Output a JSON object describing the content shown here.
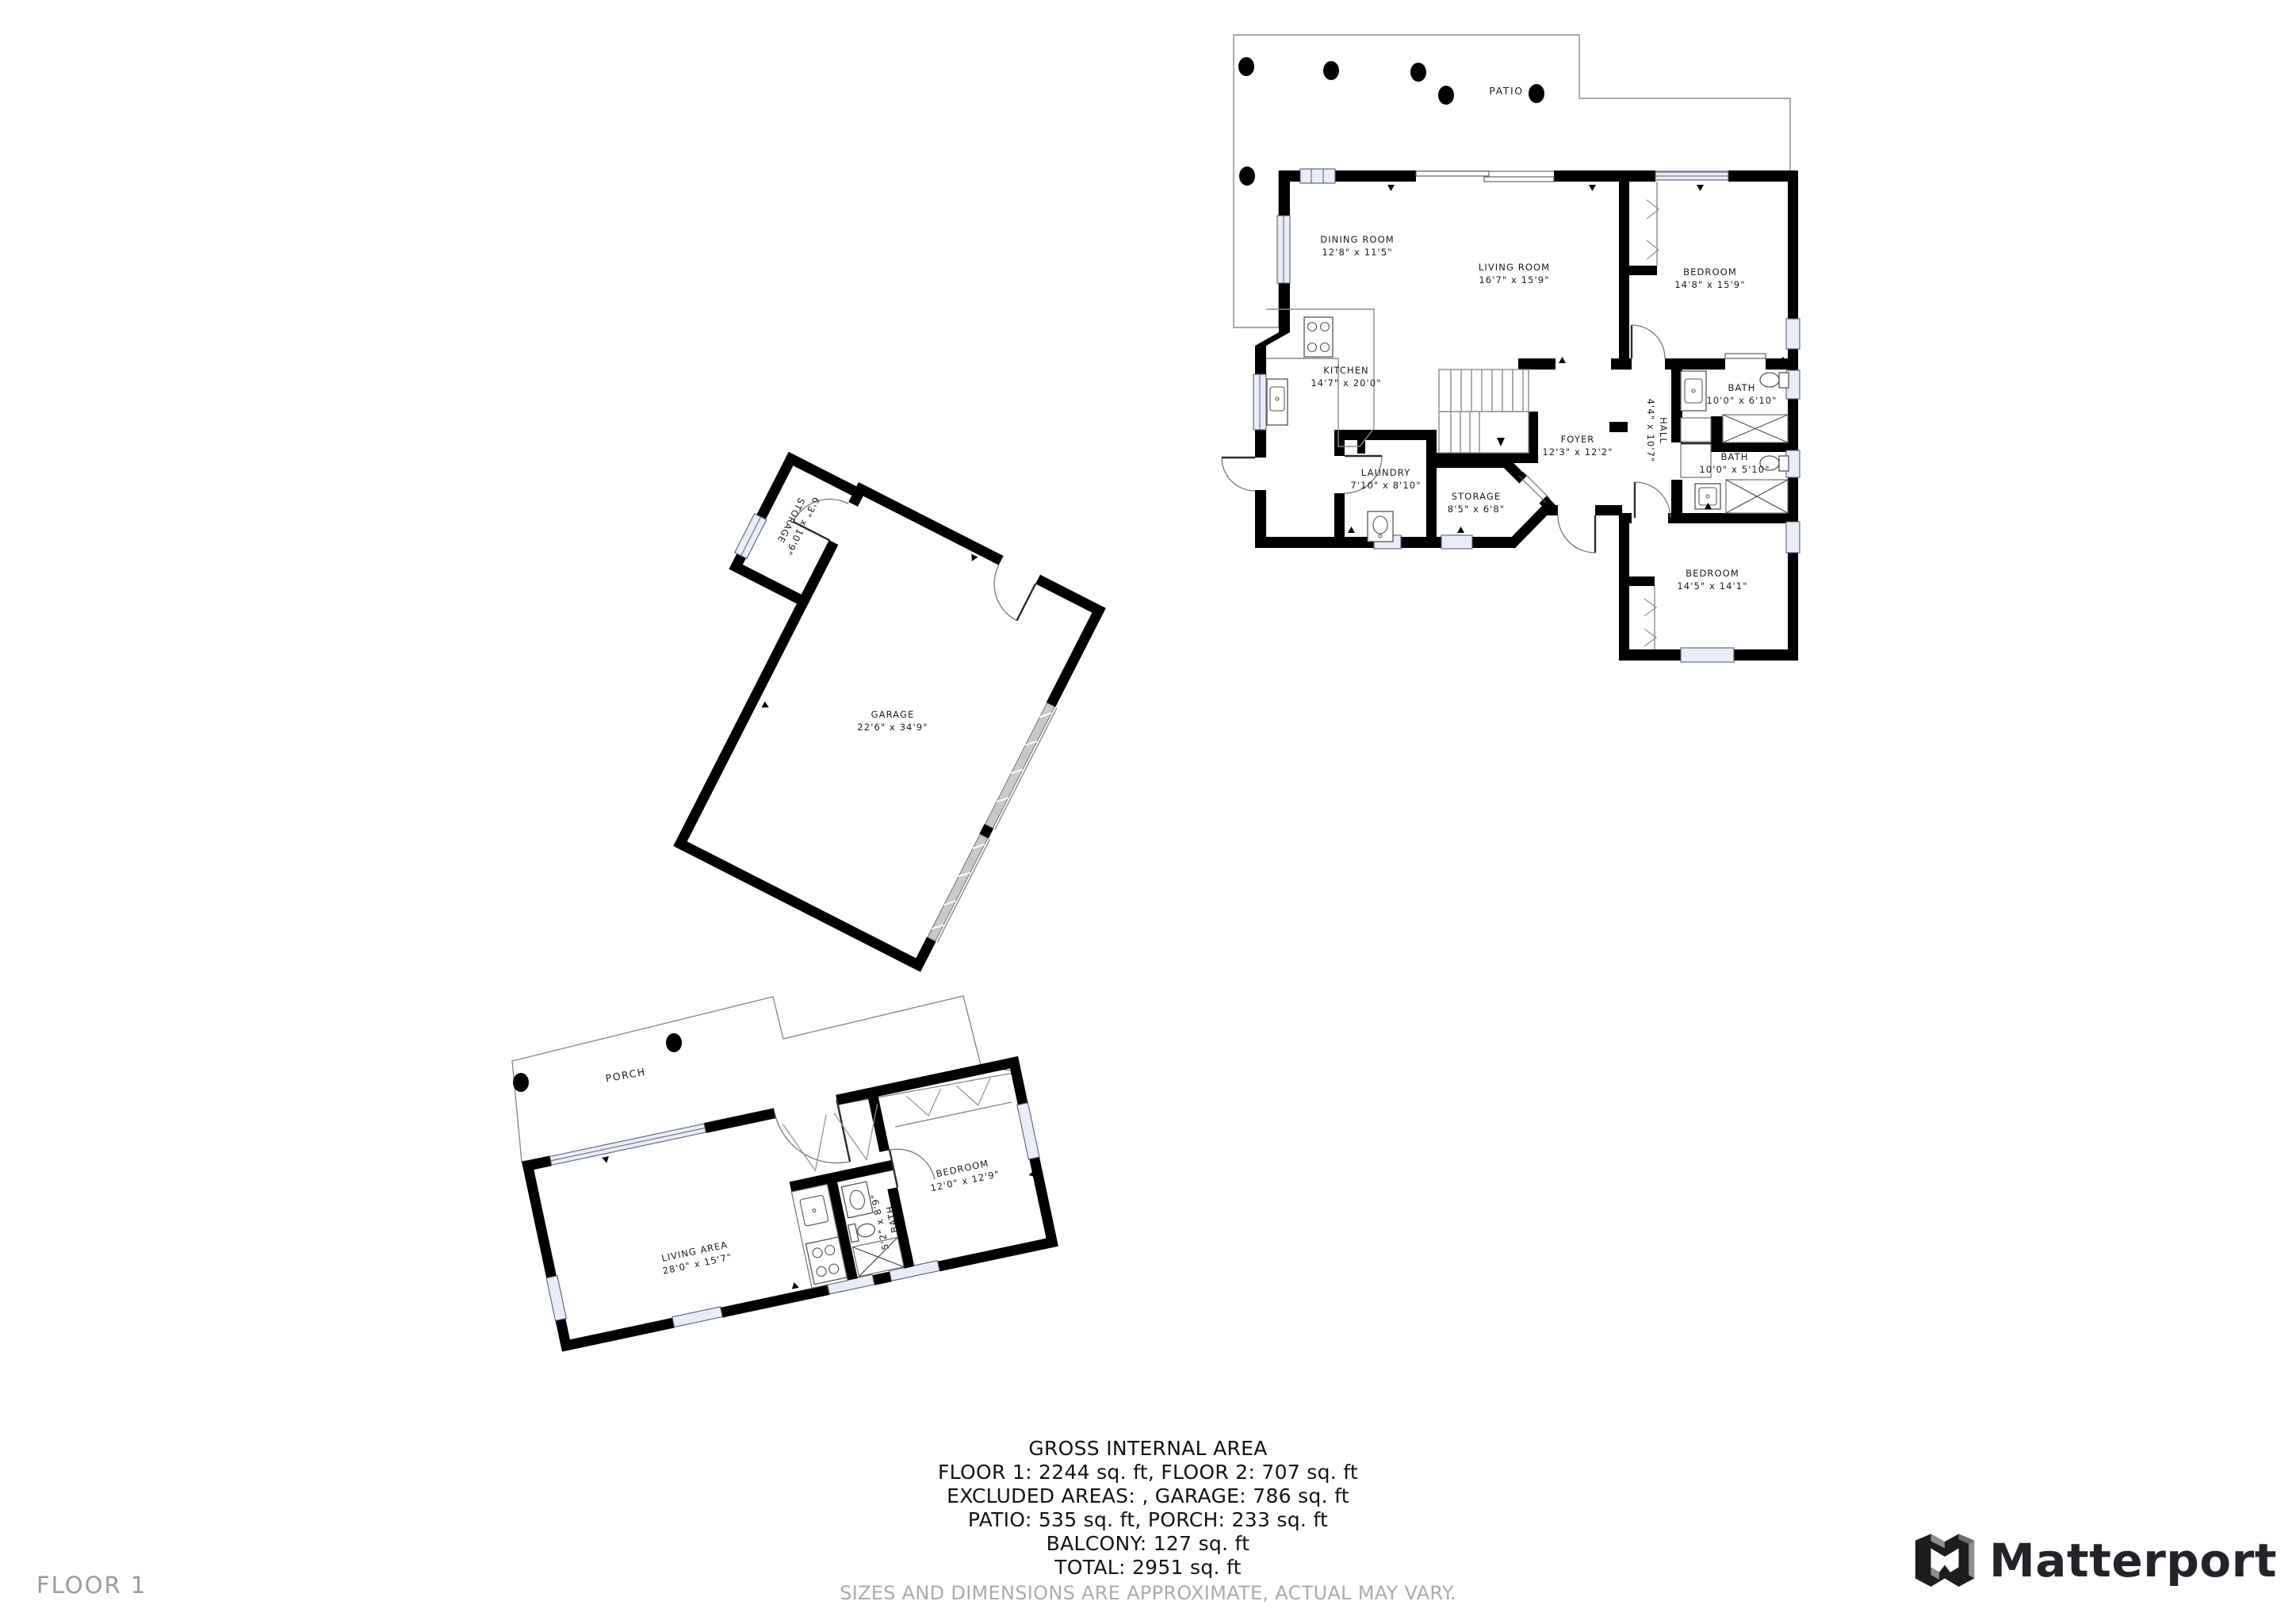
{
  "colors": {
    "wall": "#000000",
    "outline": "#8a8a8a",
    "window_fill": "#e9edf7",
    "label_text": "#1b1b1b",
    "muted_text": "#9b9b9b",
    "brand_text": "#232329"
  },
  "floor_label": "FLOOR 1",
  "brand": "Matterport",
  "footer": {
    "title": "GROSS INTERNAL AREA",
    "line1": "FLOOR 1: 2244 sq. ft, FLOOR 2: 707 sq. ft",
    "line2": "EXCLUDED AREAS: , GARAGE: 786 sq. ft",
    "line3": "PATIO: 535 sq. ft, PORCH: 233 sq. ft",
    "line4": "BALCONY: 127 sq. ft",
    "line5": "TOTAL: 2951 sq. ft",
    "disclaimer": "SIZES AND DIMENSIONS ARE APPROXIMATE, ACTUAL MAY VARY."
  },
  "rooms": {
    "patio": {
      "name": "PATIO"
    },
    "dining": {
      "name": "DINING ROOM",
      "dims": "12'8\" x 11'5\""
    },
    "living": {
      "name": "LIVING ROOM",
      "dims": "16'7\" x 15'9\""
    },
    "bedroom1": {
      "name": "BEDROOM",
      "dims": "14'8\" x 15'9\""
    },
    "kitchen": {
      "name": "KITCHEN",
      "dims": "14'7\" x 20'0\""
    },
    "laundry": {
      "name": "LAUNDRY",
      "dims": "7'10\" x 8'10\""
    },
    "storage": {
      "name": "STORAGE",
      "dims": "8'5\" x 6'8\""
    },
    "foyer": {
      "name": "FOYER",
      "dims": "12'3\" x 12'2\""
    },
    "hall": {
      "name": "HALL",
      "dims": "4'4\" x 10'7\""
    },
    "bath1": {
      "name": "BATH",
      "dims": "10'0\" x 6'10\""
    },
    "bath2": {
      "name": "BATH",
      "dims": "10'0\" x 5'10\""
    },
    "bedroom2": {
      "name": "BEDROOM",
      "dims": "14'5\" x 14'1\""
    }
  },
  "garage": {
    "garage": {
      "name": "GARAGE",
      "dims": "22'6\" x 34'9\""
    },
    "storage": {
      "name": "STORAGE",
      "dims": "6'3\" x 10'9\""
    }
  },
  "floor2": {
    "porch": {
      "name": "PORCH"
    },
    "living_area": {
      "name": "LIVING AREA",
      "dims": "28'0\" x 15'7\""
    },
    "bedroom": {
      "name": "BEDROOM",
      "dims": "12'0\" x 12'9\""
    },
    "bath": {
      "name": "BATH",
      "dims": "5'2\" x 8'9\""
    }
  }
}
